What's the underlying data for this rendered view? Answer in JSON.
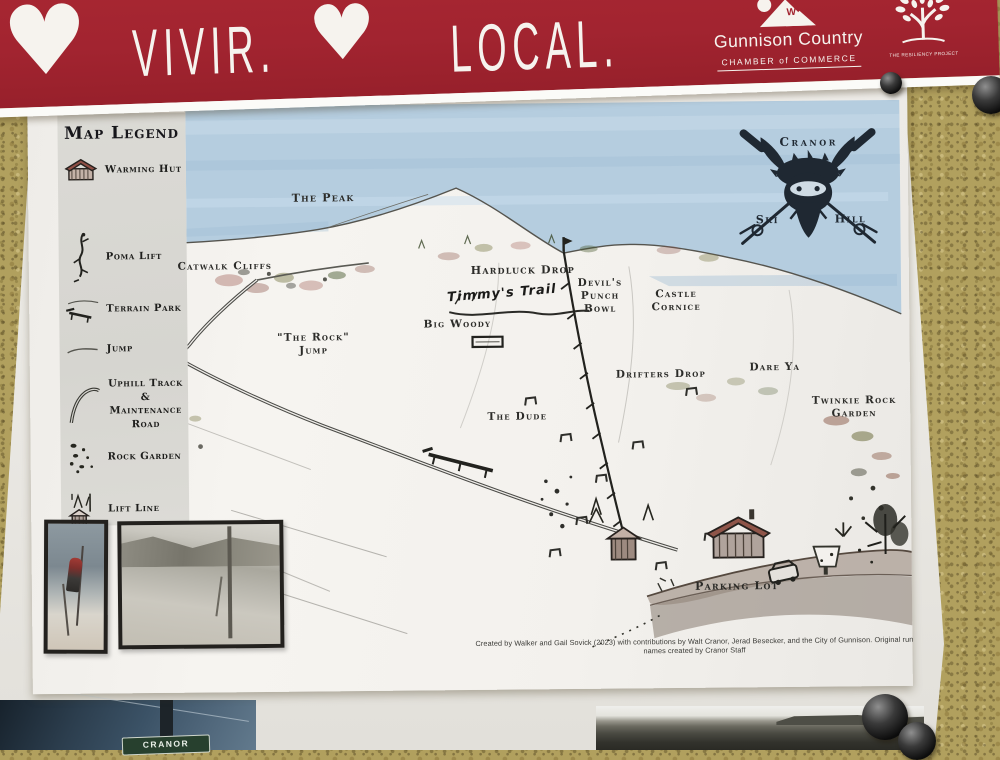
{
  "banner": {
    "heart": "♥",
    "vivir": "VIVIR.",
    "local": "LOCAL.",
    "chamber_logo": {
      "letter": "W",
      "name": "Gunnison Country",
      "subtitle": "CHAMBER of COMMERCE"
    },
    "resiliency_logo": {
      "name": "THE RESILIENCY PROJECT"
    },
    "bg_color": "#a22430"
  },
  "legend": {
    "title": "Map Legend",
    "items": [
      {
        "label": "Warming Hut"
      },
      {
        "label": "Poma Lift"
      },
      {
        "label": "Terrain Park"
      },
      {
        "label": "Jump"
      },
      {
        "label": "Uphill Track & Maintenance Road"
      },
      {
        "label": "Rock Garden"
      },
      {
        "label": "Lift Line"
      }
    ]
  },
  "logo": {
    "top": "Cranor",
    "left": "Ski",
    "right": "Hill",
    "ink_color": "#1f2832"
  },
  "map_labels": {
    "peak": "The Peak",
    "catwalk": "Catwalk Cliffs",
    "hardluck": "Hardluck Drop",
    "devils": "Devil's Punch Bowl",
    "castle": "Castle Cornice",
    "rock_jump": "\"The Rock\" Jump",
    "big_woody": "Big Woody",
    "timmys": "Timmy's Trail",
    "drifters": "Drifters Drop",
    "dare_ya": "Dare Ya",
    "twinkie": "Twinkie Rock Garden",
    "dude": "The Dude",
    "parking": "Parking Lot"
  },
  "credit": "Created by Walker and Gail Sovick (2023) with contributions by Walt Cranor, Jerad Besecker, and the City of Gunnison. Original run names created by Cranor Staff",
  "bottom": {
    "sign_text": "CRANOR"
  },
  "colors": {
    "cork": "#b1a05e",
    "sky_watercolor": "#b5cddf",
    "paper": "#f3f1ed",
    "legend_panel": "#d8d7d2"
  }
}
